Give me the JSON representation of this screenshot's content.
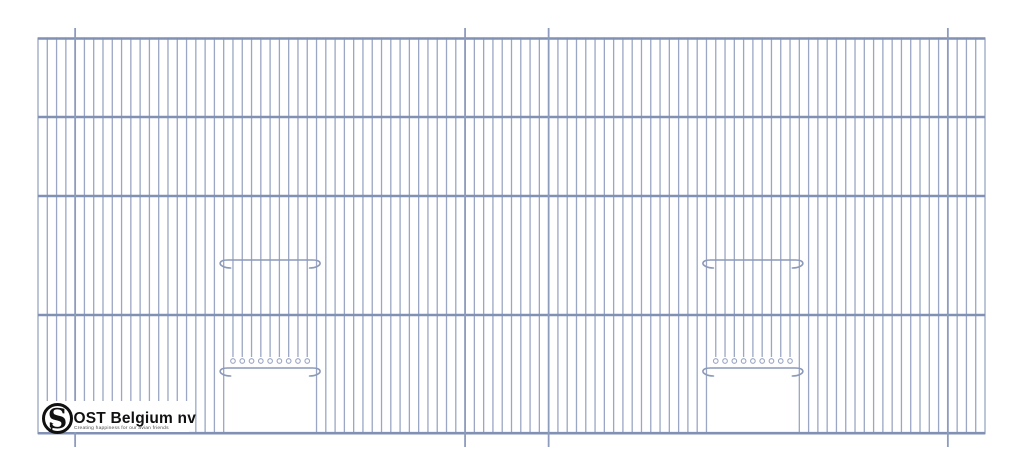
{
  "logo": {
    "monogram": "S",
    "monogram_small": "J",
    "company": "OST Belgium nv",
    "tagline": "Creating happiness for our avian friends",
    "text_color": "#111111",
    "tagline_color": "#4a4a4a"
  },
  "colors": {
    "background": "#ffffff",
    "wire": "#9aa6c3",
    "bar": "#8191b3",
    "hanger_wire": "#8d9bbc",
    "rod": "#8b99ba"
  },
  "drawing": {
    "description": "Wire mesh cage front panel with two sliding door openings",
    "panel": {
      "x0": 38,
      "x1": 985,
      "wire_top_y": 37.4,
      "wire_bottom_y": 434.2
    },
    "wire_count": 103,
    "wire_width": 1.3,
    "bar_ys": [
      38.5,
      117,
      196,
      315,
      433.2
    ],
    "bar_width": 2.6,
    "hangers": {
      "indices": [
        4,
        46,
        55,
        98
      ],
      "top_y": 28,
      "bottom_y": 447,
      "width": 1.8
    },
    "doors": [
      {
        "left_wire": 20,
        "right_wire": 30
      },
      {
        "left_wire": 72,
        "right_wire": 82
      }
    ],
    "rods": {
      "upper_y": 260,
      "lower_y": 368,
      "overhang": 4,
      "hook_drop": 8,
      "width": 1.6
    },
    "opening": {
      "top_bar_y": 368,
      "cut_end_y": 357,
      "loop_cy": 361,
      "loop_r": 2.3
    },
    "logo_box": {
      "x": 39,
      "y": 401,
      "w": 150,
      "h": 31
    },
    "logo_mark": {
      "cx": 57.5,
      "cy": 418.5,
      "r": 14,
      "ring_width": 3
    }
  }
}
